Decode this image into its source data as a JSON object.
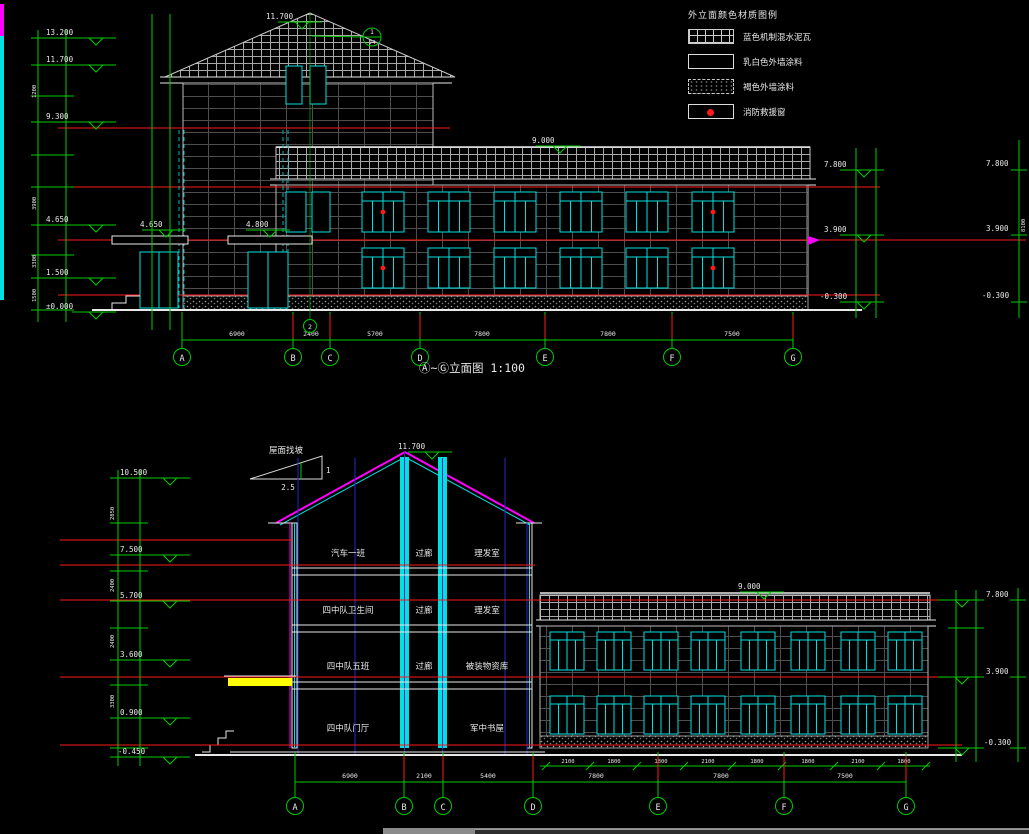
{
  "legend": {
    "title": "外立面颜色材质图例",
    "items": [
      {
        "name": "roof-tile-swatch",
        "label": "蓝色机制混水泥瓦"
      },
      {
        "name": "white-paint-swatch",
        "label": "乳白色外墙涂料"
      },
      {
        "name": "dark-paint-swatch",
        "label": "褐色外墙涂料"
      },
      {
        "name": "rescue-window-swatch",
        "label": "消防救援窗"
      }
    ]
  },
  "top_elevation": {
    "title": "Ⓐ~Ⓖ立面图 1:100",
    "ridge_level": "11.700",
    "detail_callout": {
      "top": "1",
      "bottom": "J4"
    },
    "axis_bubble_2": "2",
    "wing_ridge_level": "9.000",
    "canopy_level_left": "4.650",
    "canopy_level_right": "4.800",
    "left_levels": [
      "13.200",
      "11.700",
      "9.300",
      "4.650",
      "1.500",
      "±0.000"
    ],
    "right_levels": [
      "7.800",
      "3.900",
      "-0.300"
    ],
    "far_right_levels": [
      "7.800",
      "3.900",
      "-0.300"
    ],
    "chain_dims": [
      "1200",
      "3900",
      "3300",
      "1500"
    ],
    "right_chain_dim": "8100",
    "grid_labels": [
      "A",
      "B",
      "C",
      "D",
      "E",
      "F",
      "G"
    ],
    "grid_dims": [
      "6900",
      "2400",
      "5700",
      "7800",
      "7800",
      "7500"
    ]
  },
  "section": {
    "slope_label": "屋面找坡",
    "slope_rise": "1",
    "slope_run": "2.5",
    "ridge_level": "11.700",
    "wing_ridge_level": "9.000",
    "rooms": [
      [
        "汽车一班",
        "过廊",
        "理发室"
      ],
      [
        "四中队卫生间",
        "过廊",
        "理发室"
      ],
      [
        "四中队五班",
        "过廊",
        "被装物资库"
      ],
      [
        "四中队门厅",
        "军中书屋"
      ]
    ],
    "left_levels": [
      "10.500",
      "7.500",
      "5.700",
      "3.600",
      "0.900",
      "-0.450"
    ],
    "right_levels": [
      "7.800",
      "3.900",
      "-0.300"
    ],
    "chain_dims": [
      "2850",
      "2400",
      "2400",
      "3300"
    ],
    "grid_labels": [
      "A",
      "B",
      "C",
      "D",
      "E",
      "F",
      "G"
    ],
    "grid_dims": [
      "6900",
      "2100",
      "5400",
      "7800",
      "7800",
      "7500"
    ],
    "window_dims": [
      "2100",
      "1800",
      "1800",
      "2100",
      "1800",
      "1800",
      "2100",
      "1800"
    ]
  }
}
